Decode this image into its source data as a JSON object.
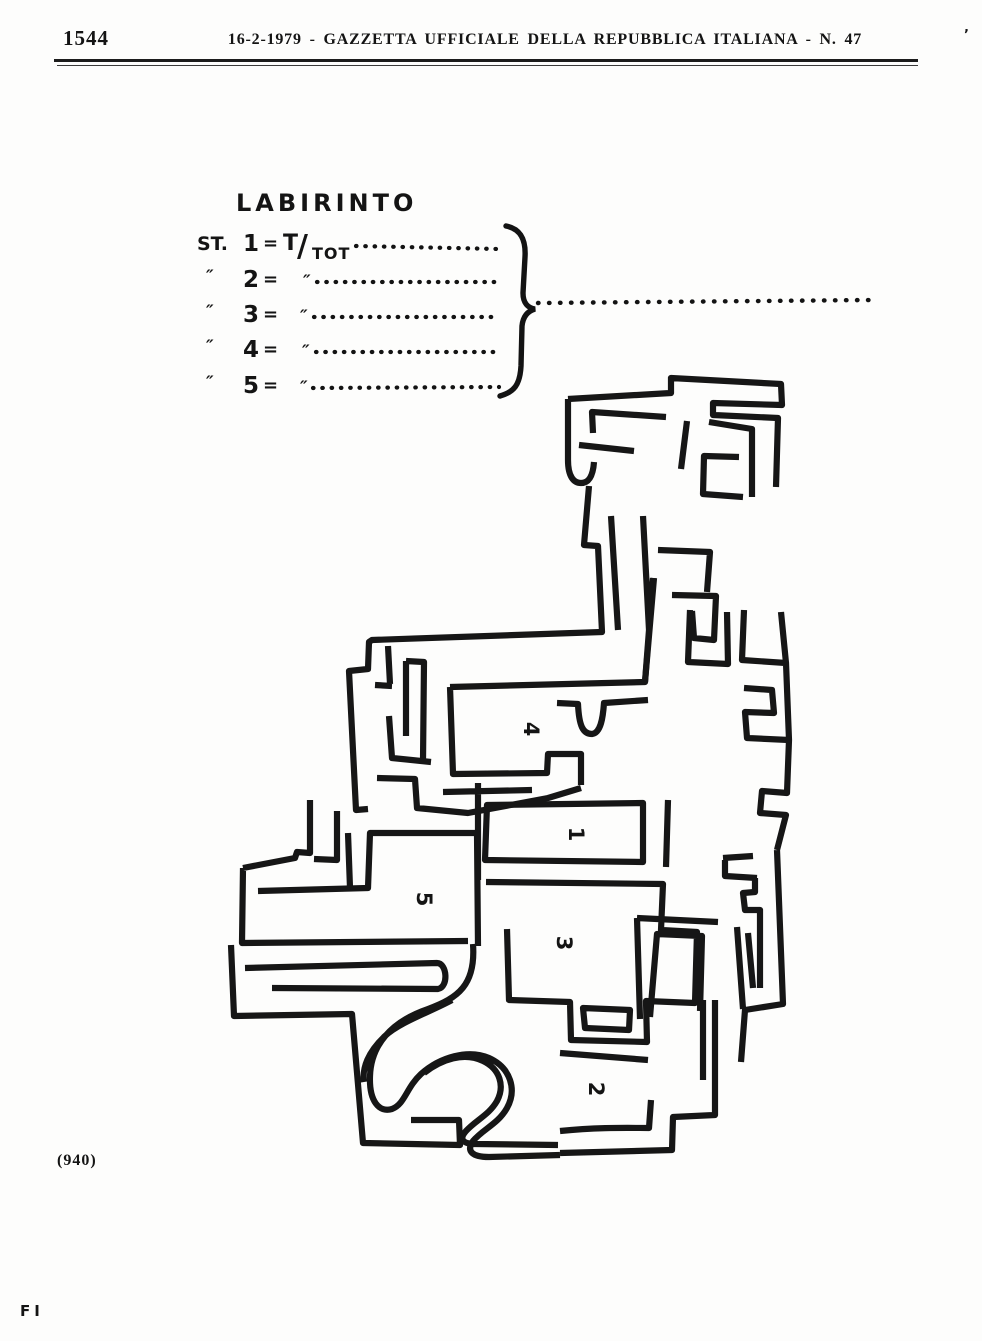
{
  "page": {
    "number": "1544",
    "header": "16-2-1979 - GAZZETTA UFFICIALE DELLA REPUBBLICA ITALIANA - N. 47",
    "header_mark": "’",
    "caption": "(940)",
    "footer": "FI"
  },
  "figure": {
    "title": "LABIRINTO",
    "rows": [
      {
        "prefix": "ST.",
        "num": "1",
        "eq": "=",
        "t": "T",
        "slash": "/",
        "tot": "TOT"
      },
      {
        "prefix": "″",
        "num": "2",
        "eq": "=",
        "ditto": "″"
      },
      {
        "prefix": "″",
        "num": "3",
        "eq": "=",
        "ditto": "″"
      },
      {
        "prefix": "″",
        "num": "4",
        "eq": "=",
        "ditto": "″"
      },
      {
        "prefix": "″",
        "num": "5",
        "eq": "=",
        "ditto": "″"
      }
    ],
    "maze_labels": {
      "r1": "1",
      "r2": "2",
      "r3": "3",
      "r4": "4",
      "r5": "5"
    }
  },
  "colors": {
    "ink": "#141414",
    "paper": "#fdfdfc"
  }
}
